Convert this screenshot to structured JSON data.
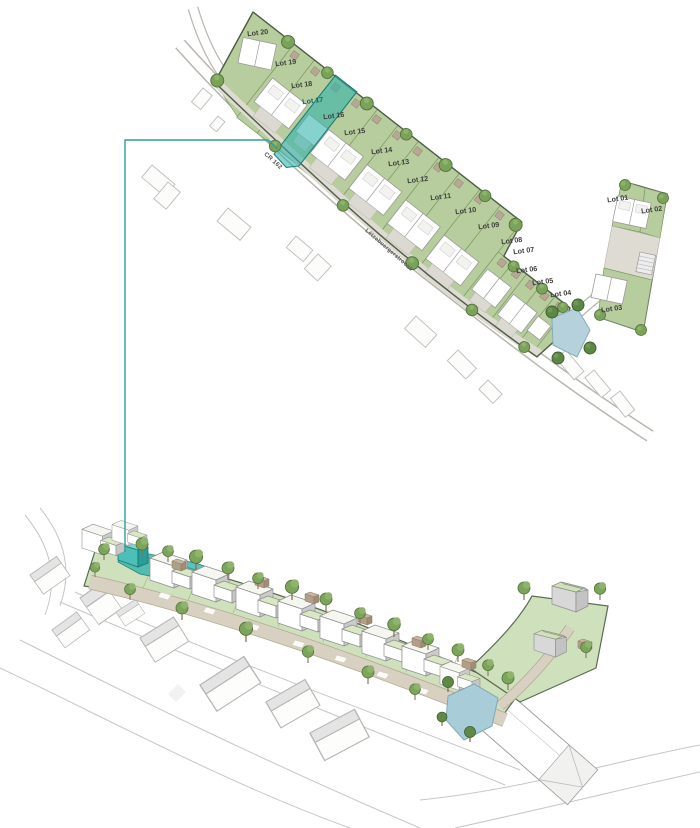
{
  "highlighted_lot": "Lot 17",
  "plan": {
    "roads": {
      "cr162": "CR 162",
      "street": "Lëtzebuergerstrooss"
    },
    "lots": [
      {
        "id": "lot-01",
        "label": "Lot 01",
        "highlighted": false
      },
      {
        "id": "lot-02",
        "label": "Lot 02",
        "highlighted": false
      },
      {
        "id": "lot-03",
        "label": "Lot 03",
        "highlighted": false
      },
      {
        "id": "lot-04",
        "label": "Lot 04",
        "highlighted": false
      },
      {
        "id": "lot-05",
        "label": "Lot 05",
        "highlighted": false
      },
      {
        "id": "lot-06",
        "label": "Lot 06",
        "highlighted": false
      },
      {
        "id": "lot-07",
        "label": "Lot 07",
        "highlighted": false
      },
      {
        "id": "lot-08",
        "label": "Lot 08",
        "highlighted": false
      },
      {
        "id": "lot-09",
        "label": "Lot 09",
        "highlighted": false
      },
      {
        "id": "lot-10",
        "label": "Lot 10",
        "highlighted": false
      },
      {
        "id": "lot-11",
        "label": "Lot 11",
        "highlighted": false
      },
      {
        "id": "lot-12",
        "label": "Lot 12",
        "highlighted": false
      },
      {
        "id": "lot-13",
        "label": "Lot 13",
        "highlighted": false
      },
      {
        "id": "lot-14",
        "label": "Lot 14",
        "highlighted": false
      },
      {
        "id": "lot-15",
        "label": "Lot 15",
        "highlighted": false
      },
      {
        "id": "lot-16",
        "label": "Lot 16",
        "highlighted": false
      },
      {
        "id": "lot-17",
        "label": "Lot 17",
        "highlighted": true
      },
      {
        "id": "lot-18",
        "label": "Lot 18",
        "highlighted": false
      },
      {
        "id": "lot-19",
        "label": "Lot 19",
        "highlighted": false
      },
      {
        "id": "lot-20",
        "label": "Lot 20",
        "highlighted": false
      }
    ]
  },
  "colors": {
    "highlight_teal": "#2fb2ab",
    "connector_teal": "#2f9ea0",
    "site_green": "#b7cd9d",
    "tree_green": "#7aa35a",
    "pond_blue": "#aed0da",
    "road_tan_3d": "#d8d1c1",
    "roof_green_3d": "#d9e7c2",
    "wall_gray_3d": "#c9c9c9",
    "house_white": "#ffffff"
  }
}
